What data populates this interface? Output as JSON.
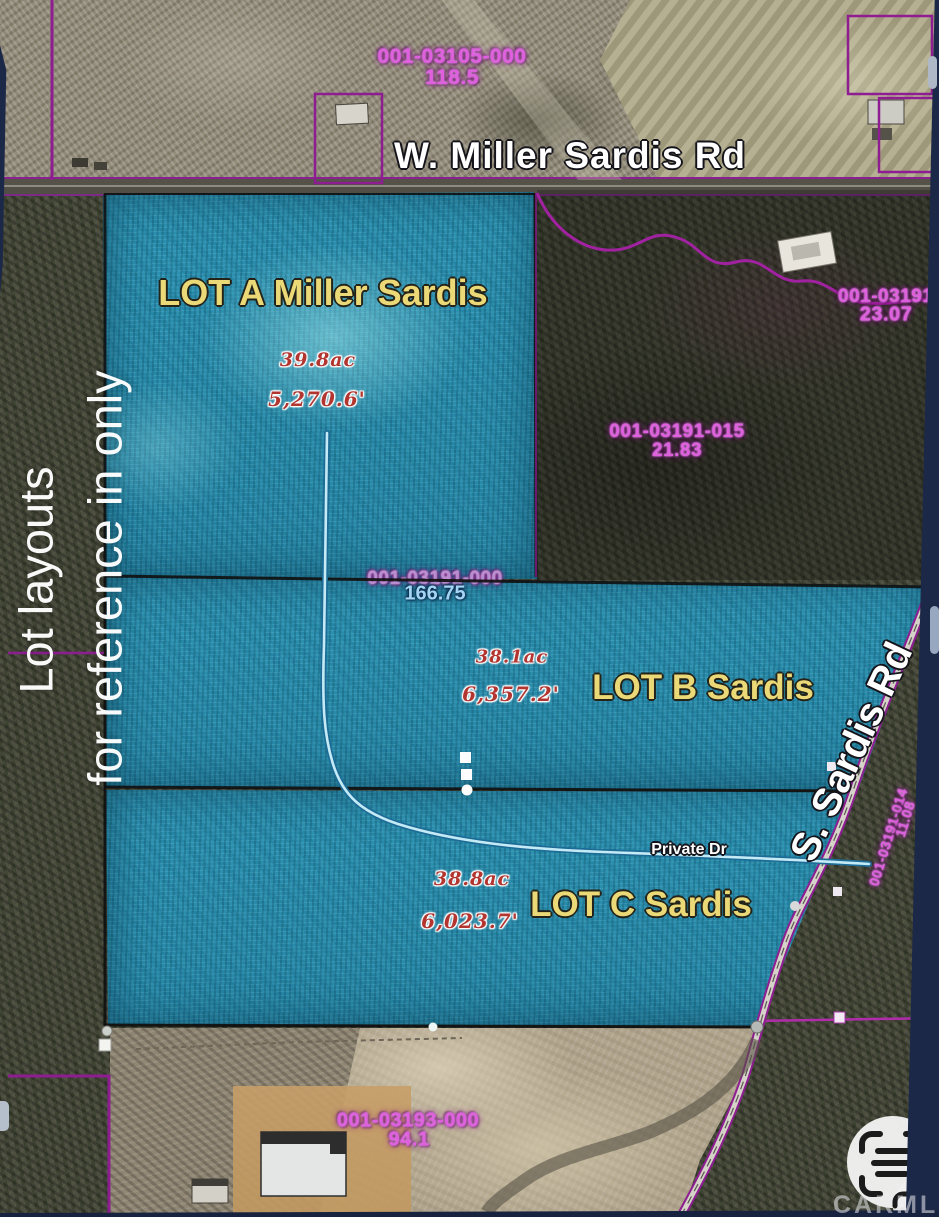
{
  "map": {
    "roads": {
      "miller_sardis_label": "W. Miller Sardis Rd",
      "s_sardis_label": "S. Sardis Rd",
      "private_dr_label": "Private Dr"
    },
    "lots": [
      {
        "name": "LOT A Miller Sardis",
        "acreage": "39.8ac",
        "perimeter": "5,270.6'"
      },
      {
        "name": "LOT B Sardis",
        "acreage": "38.1ac",
        "perimeter": "6,357.2'"
      },
      {
        "name": "LOT C Sardis",
        "acreage": "38.8ac",
        "perimeter": "6,023.7'"
      }
    ],
    "parcels": [
      {
        "parcel_id": "001-03105-000",
        "acres": "118.5"
      },
      {
        "parcel_id": "001-03191-0",
        "acres": "23.07"
      },
      {
        "parcel_id": "001-03191-015",
        "acres": "21.83"
      },
      {
        "parcel_id": "001-03191-000",
        "acres": "166.75"
      },
      {
        "parcel_id": "001-03191-014",
        "acres": "11.08"
      },
      {
        "parcel_id": "001-03193-000",
        "acres": "94.1"
      }
    ],
    "watermark": {
      "line1": "Lot layouts",
      "line2": "for reference in only"
    },
    "branding": {
      "name": "CARMLS",
      "icon": "scan-frame-icon"
    },
    "colors": {
      "lot_overlay": "#2a8fae",
      "parcel_boundary": "#8e1d92",
      "parcel_text": "#df5fdf",
      "lot_label": "#ebd977",
      "measurement_text": "#b23530",
      "selected_parcel_text": "#a5d5f5",
      "border_navy": "#1c2847"
    }
  }
}
